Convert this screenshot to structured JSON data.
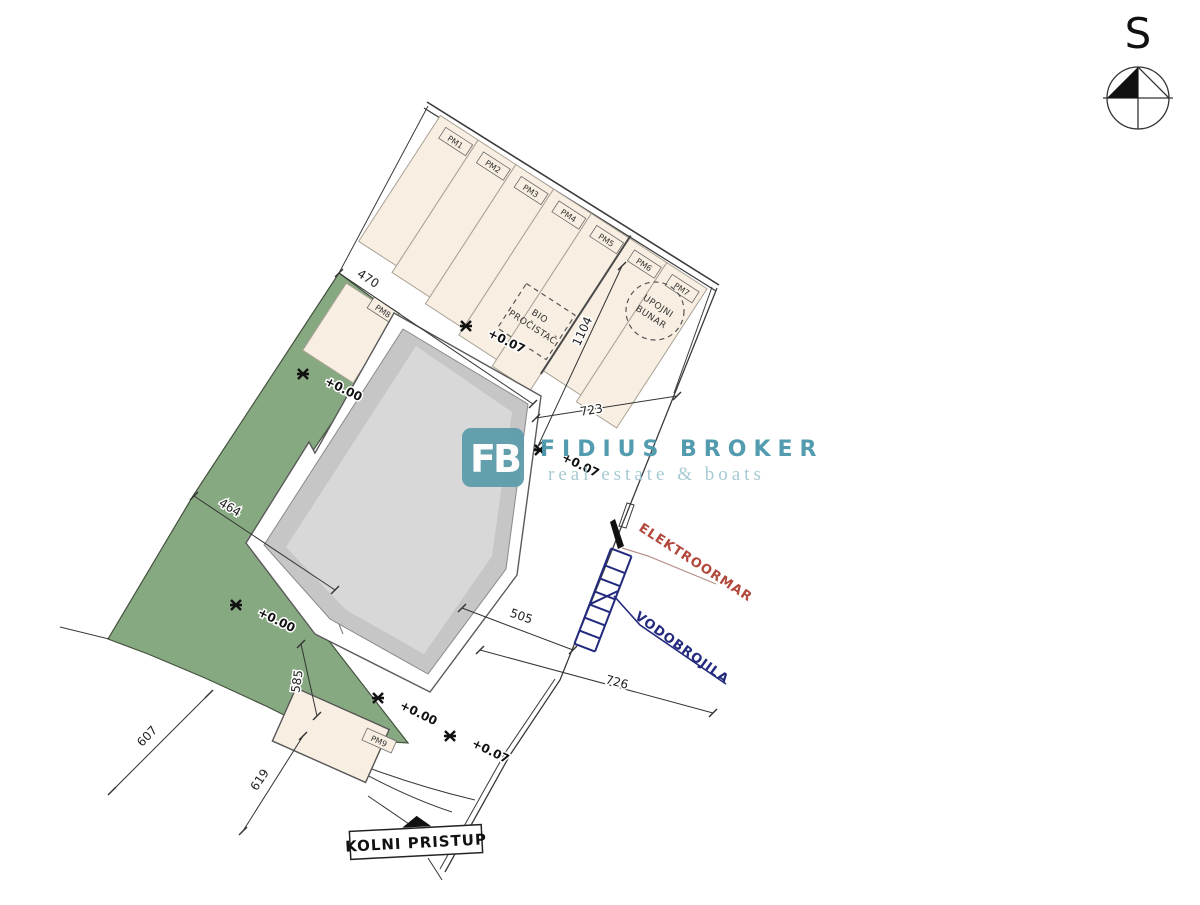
{
  "compass": {
    "label": "S"
  },
  "watermark": {
    "logo": "FB",
    "brand": "FIDIUS BROKER",
    "tagline": "real estate & boats"
  },
  "site": {
    "parking_labels": [
      "PM1",
      "PM2",
      "PM3",
      "PM4",
      "PM5",
      "PM6",
      "PM7"
    ],
    "stall8": "PM8",
    "stall9": "PM9",
    "bio_line1": "BIO",
    "bio_line2": "PROČISTAČ",
    "bunar_line1": "UPOJNI",
    "bunar_line2": "BUNAR",
    "elektroormar": "ELEKTROORMAR",
    "vodobrojila": "VODOBROJILA",
    "kolni_pristup": "KOLNI PRISTUP"
  },
  "dimensions": [
    "470",
    "723",
    "1104",
    "464",
    "505",
    "726",
    "607",
    "619",
    "585"
  ],
  "elevations": [
    "+0.07",
    "+0.07",
    "+0.07",
    "+0.00",
    "+0.00",
    "+0.00"
  ],
  "colors": {
    "green_area": "#87a981",
    "stall_beige": "#f8efe2",
    "building_gray": "#c6c6c6",
    "building_inner": "#d8d8d8",
    "elektro_red": "#b2473b",
    "vodo_blue": "#232a7e",
    "brand_teal": "#4d98ac",
    "logo_teal": "#5f9dab"
  }
}
